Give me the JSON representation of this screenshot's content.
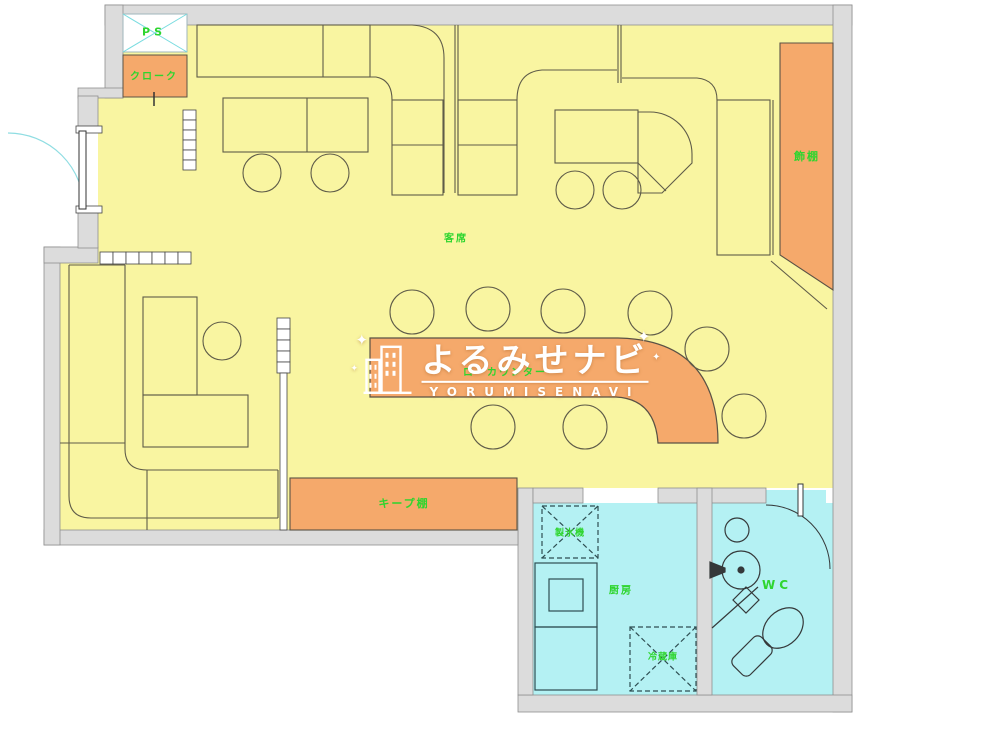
{
  "page": {
    "width": 1000,
    "height": 738,
    "background": "#ffffff"
  },
  "plan": {
    "labels": {
      "ps": "PS",
      "cloak": "クローク",
      "display_shelf": "飾棚",
      "seating_area": "客席",
      "low_counter": "ローカウンター",
      "keep_shelf": "キープ棚",
      "ice_maker": "製氷機",
      "kitchen": "厨房",
      "refrigerator": "冷蔵庫",
      "toilet": "WC"
    },
    "rooms": [
      {
        "name": "seating-area",
        "label": "客席",
        "fill": "#f9f5a1"
      },
      {
        "name": "kitchen",
        "label": "厨房",
        "fill": "#b4f1f3"
      },
      {
        "name": "toilet",
        "label": "WC",
        "fill": "#b4f1f3"
      }
    ],
    "colors": {
      "floor_yellow": "#f9f5a1",
      "fixture_orange": "#f5a96b",
      "wet_area_cyan": "#b4f1f3",
      "wall_gray": "#dcdcdc",
      "furniture_line": "#5f5c49",
      "label_green": "#2ed52e",
      "accent_cyan": "#7adce0"
    }
  },
  "watermark": {
    "brand_kana": "よるみせナビ",
    "brand_roman": "YORUMISENAVI",
    "sparkle": "✦"
  }
}
